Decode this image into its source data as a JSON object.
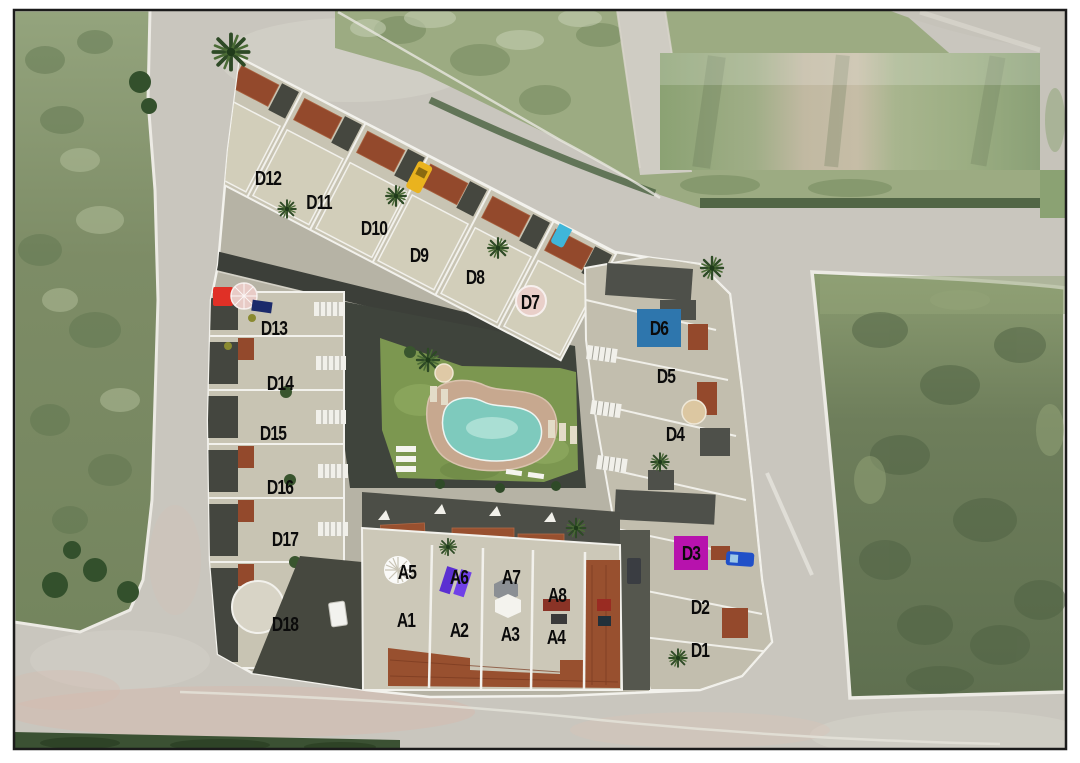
{
  "page": {
    "background": "#ffffff",
    "frame_color": "#1b1b1b"
  },
  "plan": {
    "colors": {
      "road": "#c9c6be",
      "site_concrete": "#b6b3a5",
      "building": "#c8c4b3",
      "parapet": "#f2f1ec",
      "roof_tile": "#93492c",
      "dark_roof": "#45473f",
      "lawn": "#7c9750",
      "pool_water": "#7ecabd",
      "pool_deck": "#c7a88f",
      "field_light": "#9cab82",
      "field_dark": "#6e7e5b",
      "hedge": "#3b5133",
      "label_text": "#0b0b0b",
      "d6_awning": "#2e76ad",
      "d3_awning": "#b712ad"
    },
    "props": {
      "yellow_car": "#eab31e",
      "cyan_car": "#3fb6d9",
      "blue_truck": "#2050c8",
      "red_car": "#e03026",
      "purple_lounger": "#5b2fd2",
      "tan_umbrella": "#dcc7a1",
      "pink_umbrella": "#e8cbc6"
    },
    "units": [
      {
        "id": "D12",
        "x": 268,
        "y": 178
      },
      {
        "id": "D11",
        "x": 319,
        "y": 202
      },
      {
        "id": "D10",
        "x": 374,
        "y": 228
      },
      {
        "id": "D9",
        "x": 419,
        "y": 255
      },
      {
        "id": "D8",
        "x": 475,
        "y": 277
      },
      {
        "id": "D7",
        "x": 530,
        "y": 302
      },
      {
        "id": "D13",
        "x": 274,
        "y": 328
      },
      {
        "id": "D14",
        "x": 280,
        "y": 383
      },
      {
        "id": "D15",
        "x": 273,
        "y": 433
      },
      {
        "id": "D16",
        "x": 280,
        "y": 487
      },
      {
        "id": "D17",
        "x": 285,
        "y": 539
      },
      {
        "id": "D18",
        "x": 285,
        "y": 624
      },
      {
        "id": "D6",
        "x": 659,
        "y": 328,
        "bg": "#2e76ad",
        "bgw": 44,
        "bgh": 38
      },
      {
        "id": "D5",
        "x": 666,
        "y": 376
      },
      {
        "id": "D4",
        "x": 675,
        "y": 434
      },
      {
        "id": "D3",
        "x": 691,
        "y": 553,
        "bg": "#b712ad",
        "bgw": 34,
        "bgh": 34
      },
      {
        "id": "D2",
        "x": 700,
        "y": 607
      },
      {
        "id": "D1",
        "x": 700,
        "y": 650
      },
      {
        "id": "A5",
        "x": 407,
        "y": 572
      },
      {
        "id": "A6",
        "x": 459,
        "y": 577
      },
      {
        "id": "A7",
        "x": 511,
        "y": 577
      },
      {
        "id": "A8",
        "x": 557,
        "y": 595
      },
      {
        "id": "A1",
        "x": 406,
        "y": 620
      },
      {
        "id": "A2",
        "x": 459,
        "y": 630
      },
      {
        "id": "A3",
        "x": 510,
        "y": 634
      },
      {
        "id": "A4",
        "x": 556,
        "y": 637
      }
    ]
  }
}
